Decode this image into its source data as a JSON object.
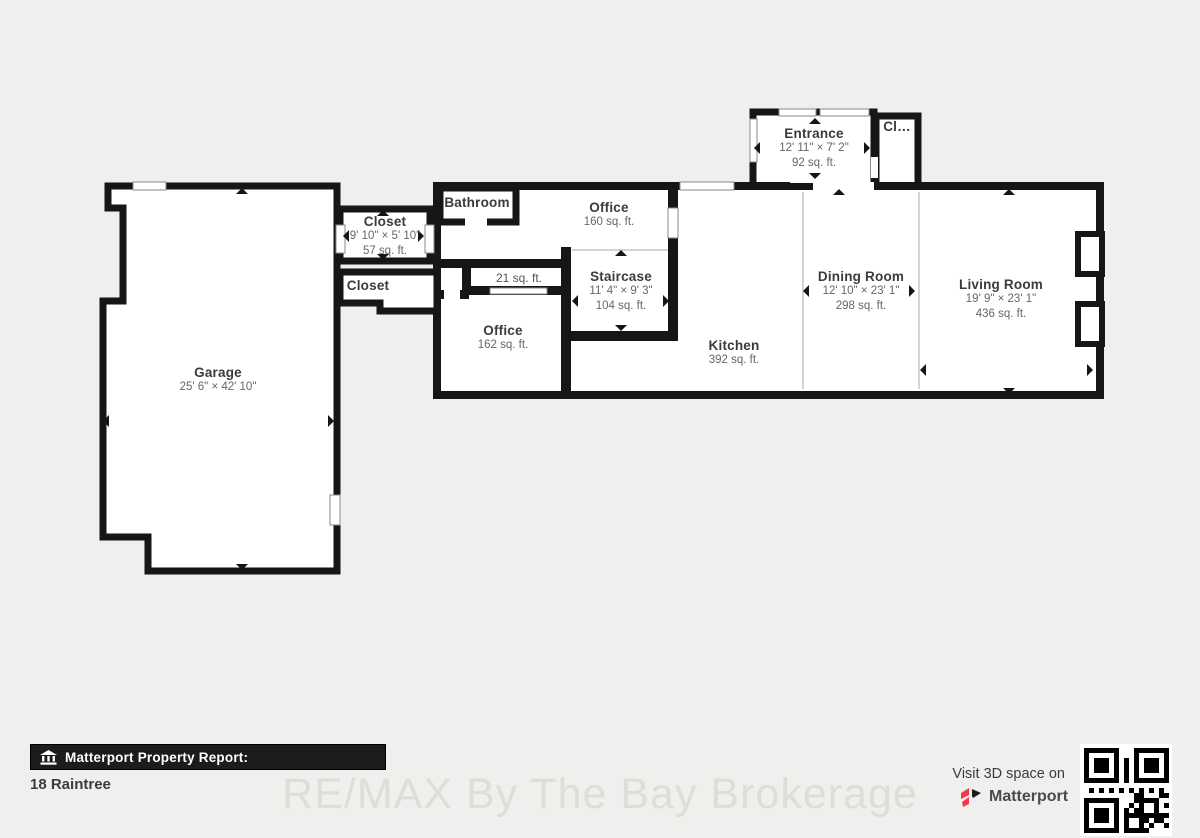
{
  "colors": {
    "background": "#f0efed",
    "wall": "#161616",
    "room_fill": "#ffffff",
    "divider": "#c8c6c3",
    "name_text": "#3b3b3b",
    "dim_text": "#666666",
    "bar_bg": "#1c1c1c",
    "brand_pink": "#f4364c",
    "watermark_text": "#dfddd9"
  },
  "floorplan": {
    "rooms": [
      {
        "id": "entrance",
        "name": "Entrance",
        "dims": "12' 11\" × 7' 2\"",
        "area": "92 sq. ft."
      },
      {
        "id": "entry-closet",
        "name": "Cl…"
      },
      {
        "id": "bathroom",
        "name": "Bathroom"
      },
      {
        "id": "office-upper",
        "name": "Office",
        "area": "160 sq. ft."
      },
      {
        "id": "closet-main",
        "name": "Closet",
        "dims": "9' 10\" × 5' 10\"",
        "area": "57 sq. ft."
      },
      {
        "id": "closet-second",
        "name": "Closet"
      },
      {
        "id": "storage-21",
        "name": "",
        "area": "21 sq. ft."
      },
      {
        "id": "office-lower",
        "name": "Office",
        "area": "162 sq. ft."
      },
      {
        "id": "staircase",
        "name": "Staircase",
        "dims": "11' 4\" × 9' 3\"",
        "area": "104 sq. ft."
      },
      {
        "id": "kitchen",
        "name": "Kitchen",
        "area": "392 sq. ft."
      },
      {
        "id": "dining-room",
        "name": "Dining Room",
        "dims": "12' 10\" × 23' 1\"",
        "area": "298 sq. ft."
      },
      {
        "id": "living-room",
        "name": "Living Room",
        "dims": "19' 9\" × 23' 1\"",
        "area": "436 sq. ft."
      },
      {
        "id": "garage",
        "name": "Garage",
        "dims": "25' 6\" × 42' 10\""
      }
    ]
  },
  "footer": {
    "report_label": "Matterport Property Report:",
    "property_name": "18 Raintree",
    "watermark": "RE/MAX By The Bay Brokerage",
    "visit_text": "Visit 3D space on",
    "brand_name": "Matterport"
  }
}
